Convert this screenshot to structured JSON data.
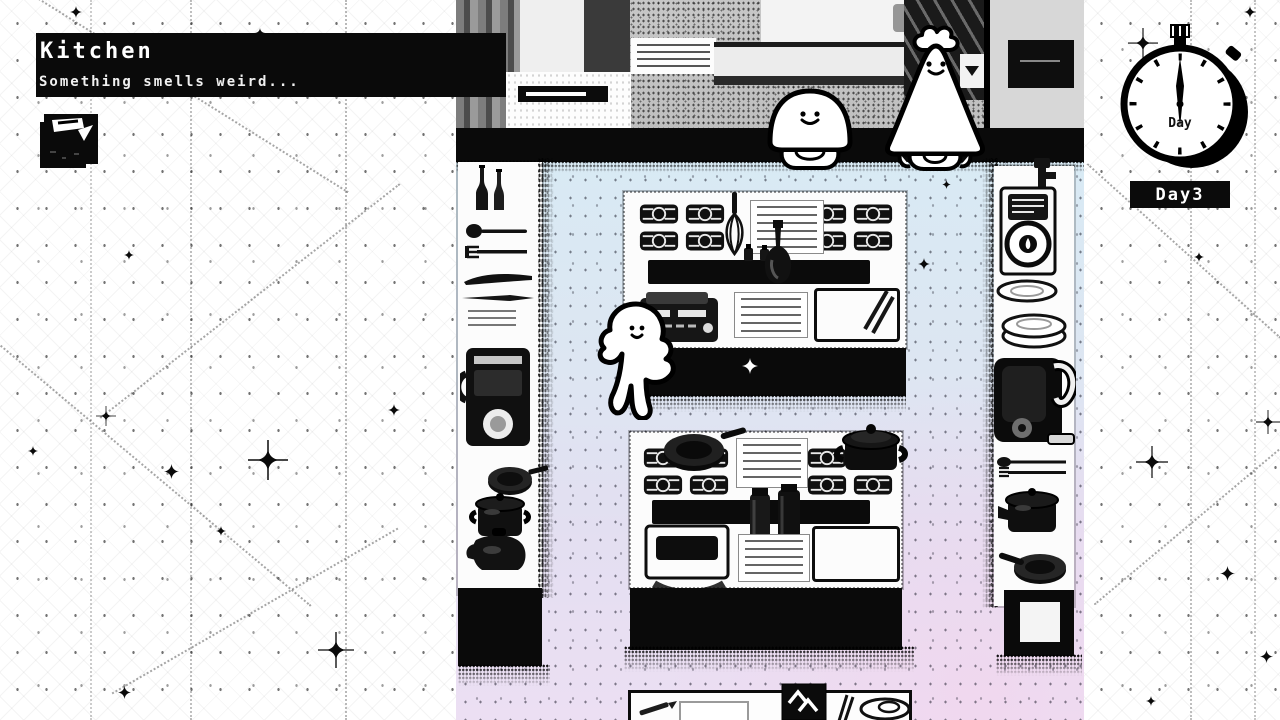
{
  "hud": {
    "location": {
      "title": "Kitchen",
      "subtitle": "Something smells weird..."
    },
    "day": {
      "clock_label": "Day",
      "badge": "Day3"
    }
  },
  "scene": {
    "characters": [
      {
        "id": "round-blob-character"
      },
      {
        "id": "chef-blob-character"
      },
      {
        "id": "ghost-character"
      }
    ],
    "colors": {
      "floor_top": "#d8eaf4",
      "floor_bottom": "#ecdff3",
      "ink": "#0a0a0a",
      "paper": "#ffffff"
    }
  }
}
